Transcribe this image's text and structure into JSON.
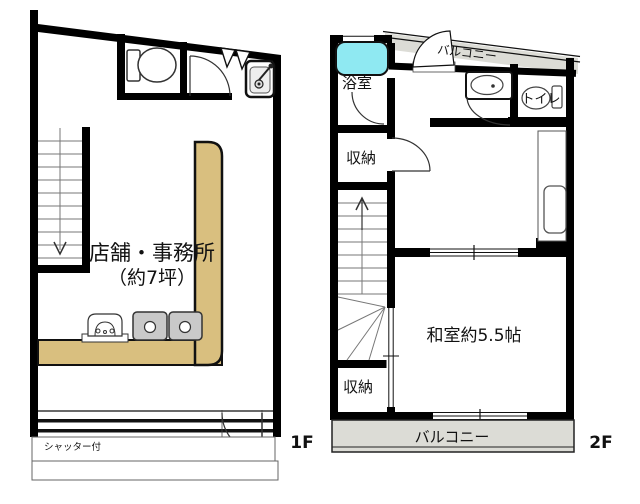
{
  "plan_title": "2-story shop/residence floor plan",
  "colors": {
    "wall": "#000000",
    "counter_tan": "#D9BF7F",
    "bathtub_cyan": "#8FE9F2",
    "balcony_gray": "#DCDCD6",
    "sink_gray": "#C9C9C9"
  },
  "floor1": {
    "floor_label": "1F",
    "shop_label": "店舗・事務所",
    "shop_area_label": "（約7坪）",
    "shutter_label": "シャッター付"
  },
  "floor2": {
    "floor_label": "2F",
    "bath_label": "浴室",
    "balcony_top_label": "バルコニー",
    "toilet_label": "トイレ",
    "storage_upper_label": "収納",
    "storage_lower_label": "収納",
    "japanese_room_label": "和室約5.5帖",
    "balcony_bottom_label": "バルコニー"
  }
}
